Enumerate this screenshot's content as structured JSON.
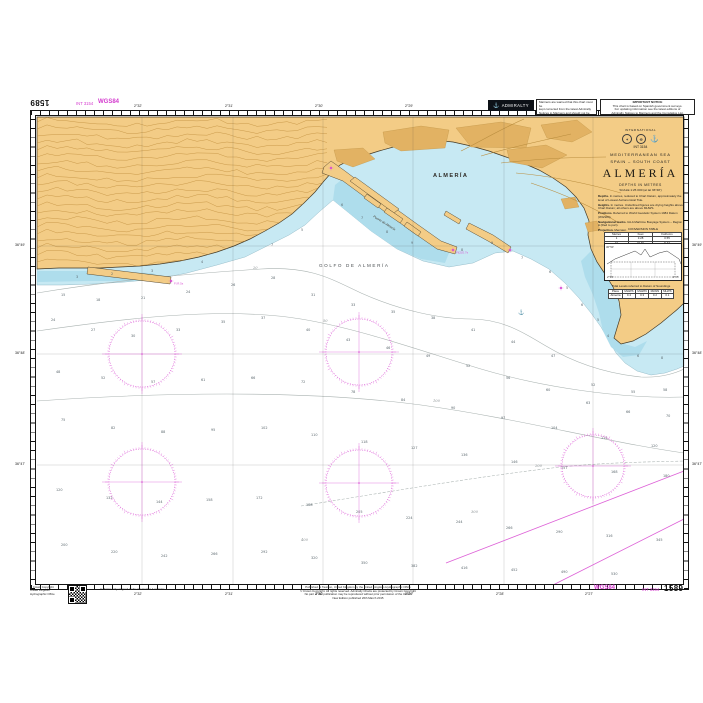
{
  "chart": {
    "number": "1589",
    "int_number": "INT 3154",
    "datum_label": "WGS84"
  },
  "header": {
    "admiralty": "ADMIRALTY",
    "notice1_lines": [
      "Mariners are warned that this chart must be",
      "kept corrected from the latest Admiralty",
      "Notices to Mariners and should not be used",
      "without reference to the largest scale chart",
      "of the area."
    ],
    "notice2_title": "IMPORTANT NOTICE",
    "notice2_lines": [
      "This chart is based on Spanish government surveys.",
      "For updating information see the latest editions of",
      "Admiralty Notices to Mariners and the Cumulative List.",
      "Further information may be obtained from the UKHO, Taunton."
    ]
  },
  "title_block": {
    "international": "INTERNATIONAL",
    "series": "INT 3154",
    "sea": "MEDITERRANEAN SEA",
    "region": "SPAIN – SOUTH COAST",
    "title": "ALMERÍA",
    "depths": "DEPTHS IN METRES",
    "scale": "SCALE 1:25 000 (at lat 36°48')",
    "paragraphs": [
      {
        "lead": "Depths.",
        "text": " In metres, reduced to Chart Datum, approximately the level of Lowest Astronomical Tide."
      },
      {
        "lead": "Heights.",
        "text": " In metres. Underlined figures are drying heights above Chart Datum; all others are above MHWS."
      },
      {
        "lead": "Positions.",
        "text": " Referred to World Geodetic System 1984 Datum (WGS84)."
      },
      {
        "lead": "Navigational marks.",
        "text": " IALA Maritime Buoyage System – Region A (Red to port)."
      },
      {
        "lead": "Projection.",
        "text": " Mercator."
      }
    ],
    "note_title": "SATELLITE-DERIVED POSITIONS",
    "note_lines": [
      "Positions obtained from satellite navigation",
      "systems are normally referred to WGS84 Datum;",
      "such positions can be plotted directly on",
      "this chart."
    ]
  },
  "conversion_table": {
    "title": "CONVERSION TABLE",
    "headers": [
      "Metres",
      "Feet",
      "Fathoms"
    ],
    "rows": [
      [
        "1",
        "3.28",
        "0.55"
      ],
      [
        "10",
        "32.81",
        "5.47"
      ],
      [
        "100",
        "328.08",
        "54.68"
      ]
    ]
  },
  "inset": {
    "bl": "2°30'",
    "br": "2°25'",
    "tl": "36°50'"
  },
  "tidal_table": {
    "title": "Tidal Levels referred to Datum of Soundings",
    "headers": [
      "Place",
      "MHWS",
      "MHWN",
      "MLWN",
      "MLWS"
    ],
    "rows": [
      [
        "Almería",
        "0.4",
        "0.3",
        "0.2",
        "0.1"
      ]
    ]
  },
  "map_labels": {
    "city": "ALMERÍA",
    "gulf": "GOLFO DE ALMERÍA",
    "port": "Puerto de Almería"
  },
  "border_labels": {
    "top": [
      {
        "x": 141,
        "t": "2°32'"
      },
      {
        "x": 232,
        "t": "2°31'"
      },
      {
        "x": 322,
        "t": "2°30'"
      },
      {
        "x": 412,
        "t": "2°29'"
      },
      {
        "x": 503,
        "t": "2°28'"
      },
      {
        "x": 592,
        "t": "2°27'"
      }
    ],
    "bottom": [
      {
        "x": 141,
        "t": "2°32'"
      },
      {
        "x": 232,
        "t": "2°31'"
      },
      {
        "x": 322,
        "t": "2°30'"
      },
      {
        "x": 412,
        "t": "2°29'"
      },
      {
        "x": 503,
        "t": "2°28'"
      },
      {
        "x": 592,
        "t": "2°27'"
      }
    ],
    "left": [
      {
        "y": 245,
        "t": "36°49'"
      },
      {
        "y": 353,
        "t": "36°48'"
      },
      {
        "y": 464,
        "t": "36°47'"
      }
    ],
    "right": [
      {
        "y": 245,
        "t": "36°49'"
      },
      {
        "y": 353,
        "t": "36°48'"
      },
      {
        "y": 464,
        "t": "36°47'"
      }
    ]
  },
  "footer": {
    "qr_lines": [
      "© Crown Copyright",
      "United Kingdom",
      "Hydrographic Office"
    ],
    "left_note": "A chart is only as good as the information it contains.",
    "center_lines": [
      "Published at Taunton, United Kingdom by the United Kingdom Hydrographic Office",
      "© Crown Copyright. All rights reserved. Admiralty Charts are protected by Crown Copyright",
      "No part of this publication may be reproduced without prior permission of the UKHO",
      "New Edition published 26th March 2015"
    ],
    "wgs": "WGS84",
    "int": "INT 3154",
    "number": "1589"
  },
  "lights": [
    {
      "x": 452,
      "y": 249,
      "t": "Fl(2)G.7s"
    },
    {
      "x": 170,
      "y": 280,
      "t": "Fl.R.5s"
    },
    {
      "x": 509,
      "y": 249,
      "t": ""
    },
    {
      "x": 330,
      "y": 167,
      "t": ""
    },
    {
      "x": 560,
      "y": 287,
      "t": ""
    }
  ],
  "anchorage": {
    "x": 520,
    "y": 310
  },
  "roses": [
    {
      "x": 141,
      "y": 353,
      "r": 33
    },
    {
      "x": 358,
      "y": 351,
      "r": 33
    },
    {
      "x": 141,
      "y": 481,
      "r": 33
    },
    {
      "x": 358,
      "y": 482,
      "r": 33
    },
    {
      "x": 592,
      "y": 465,
      "r": 31
    }
  ],
  "contour_labels": [
    [
      252,
      268,
      "20"
    ],
    [
      322,
      321,
      "50"
    ],
    [
      432,
      401,
      "100"
    ],
    [
      534,
      466,
      "200"
    ],
    [
      470,
      512,
      "300"
    ],
    [
      300,
      540,
      "400"
    ]
  ],
  "soundings": [
    [
      340,
      205,
      6
    ],
    [
      360,
      218,
      7
    ],
    [
      385,
      232,
      8
    ],
    [
      410,
      243,
      9
    ],
    [
      300,
      230,
      5
    ],
    [
      270,
      245,
      7
    ],
    [
      200,
      262,
      4
    ],
    [
      150,
      271,
      3
    ],
    [
      110,
      274,
      2
    ],
    [
      75,
      277,
      3
    ],
    [
      460,
      250,
      8
    ],
    [
      490,
      243,
      9
    ],
    [
      520,
      258,
      7
    ],
    [
      548,
      272,
      6
    ],
    [
      565,
      288,
      5
    ],
    [
      580,
      305,
      6
    ],
    [
      596,
      320,
      5
    ],
    [
      606,
      336,
      4
    ],
    [
      636,
      356,
      6
    ],
    [
      660,
      358,
      8
    ],
    [
      60,
      295,
      15
    ],
    [
      95,
      300,
      18
    ],
    [
      140,
      298,
      21
    ],
    [
      185,
      292,
      24
    ],
    [
      230,
      285,
      26
    ],
    [
      270,
      278,
      28
    ],
    [
      310,
      295,
      31
    ],
    [
      350,
      305,
      33
    ],
    [
      390,
      312,
      35
    ],
    [
      430,
      318,
      38
    ],
    [
      470,
      330,
      41
    ],
    [
      510,
      342,
      44
    ],
    [
      550,
      356,
      47
    ],
    [
      590,
      385,
      52
    ],
    [
      630,
      392,
      55
    ],
    [
      662,
      390,
      58
    ],
    [
      50,
      320,
      24
    ],
    [
      90,
      330,
      27
    ],
    [
      130,
      336,
      30
    ],
    [
      175,
      330,
      33
    ],
    [
      220,
      322,
      35
    ],
    [
      260,
      318,
      37
    ],
    [
      305,
      330,
      40
    ],
    [
      345,
      340,
      43
    ],
    [
      385,
      348,
      46
    ],
    [
      425,
      356,
      49
    ],
    [
      465,
      366,
      52
    ],
    [
      505,
      378,
      56
    ],
    [
      545,
      390,
      60
    ],
    [
      585,
      403,
      63
    ],
    [
      625,
      412,
      66
    ],
    [
      665,
      416,
      70
    ],
    [
      55,
      372,
      48
    ],
    [
      100,
      378,
      52
    ],
    [
      150,
      382,
      57
    ],
    [
      200,
      380,
      61
    ],
    [
      250,
      378,
      66
    ],
    [
      300,
      382,
      72
    ],
    [
      350,
      392,
      78
    ],
    [
      400,
      400,
      84
    ],
    [
      450,
      408,
      90
    ],
    [
      500,
      418,
      97
    ],
    [
      550,
      428,
      104
    ],
    [
      600,
      438,
      112
    ],
    [
      650,
      446,
      120
    ],
    [
      60,
      420,
      75
    ],
    [
      110,
      428,
      82
    ],
    [
      160,
      432,
      88
    ],
    [
      210,
      430,
      95
    ],
    [
      260,
      428,
      102
    ],
    [
      310,
      435,
      110
    ],
    [
      360,
      442,
      118
    ],
    [
      410,
      448,
      127
    ],
    [
      460,
      455,
      136
    ],
    [
      510,
      462,
      146
    ],
    [
      560,
      468,
      157
    ],
    [
      610,
      472,
      168
    ],
    [
      662,
      476,
      180
    ],
    [
      55,
      490,
      120
    ],
    [
      105,
      498,
      132
    ],
    [
      155,
      502,
      144
    ],
    [
      205,
      500,
      158
    ],
    [
      255,
      498,
      172
    ],
    [
      305,
      505,
      188
    ],
    [
      355,
      512,
      205
    ],
    [
      405,
      518,
      224
    ],
    [
      455,
      522,
      244
    ],
    [
      505,
      528,
      266
    ],
    [
      555,
      532,
      290
    ],
    [
      605,
      536,
      316
    ],
    [
      655,
      540,
      345
    ],
    [
      60,
      545,
      200
    ],
    [
      110,
      552,
      220
    ],
    [
      160,
      556,
      242
    ],
    [
      210,
      554,
      266
    ],
    [
      260,
      552,
      292
    ],
    [
      310,
      558,
      320
    ],
    [
      360,
      563,
      350
    ],
    [
      410,
      566,
      382
    ],
    [
      460,
      568,
      416
    ],
    [
      510,
      570,
      452
    ],
    [
      560,
      572,
      490
    ],
    [
      610,
      574,
      530
    ]
  ],
  "colors": {
    "land": "#F3CC86",
    "shallow": "#C7E9F3",
    "shallow_dark": "#AEDDEC",
    "magenta": "#D94FD3",
    "land_contour": "#C2913F",
    "urban": "#E2B263",
    "sea_contour": "#a9b2b0",
    "frame": "#141414"
  }
}
